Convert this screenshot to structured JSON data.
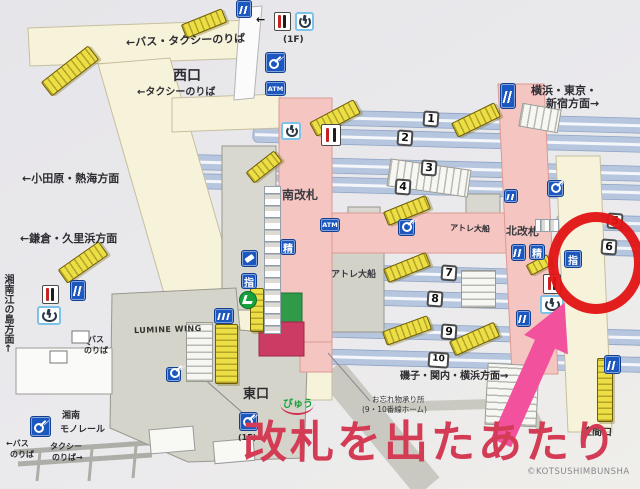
{
  "map": {
    "annotation": {
      "headline": "改札を出たあたり",
      "copyright": "©KOTSUSHIMBUNSHA"
    },
    "exits": {
      "west": "西口",
      "east": "東口",
      "kasama": "笠間口"
    },
    "gates": {
      "south": "南改札",
      "north": "北改札"
    },
    "directions": {
      "bus_taxi_top": "←バス・タクシーのりば",
      "taxi_west": "←タクシーのりば",
      "yokohama_line1": "横浜・東京・",
      "yokohama_line2": "新宿方面→",
      "odawara": "←小田原・熱海方面",
      "kamakura": "←鎌倉・久里浜方面",
      "enoshima": "湘南江の島方面←",
      "isogo": "磯子・関内・横浜方面→"
    },
    "facilities": {
      "atre_corridor": "アトレ大船",
      "atre_building": "アトレ大船",
      "lumine": "LUMINE WING",
      "view_plaza": "びゅう",
      "lost_found_line1": "お忘れ物承り所",
      "lost_found_line2": "(9・10番線ホーム)",
      "monorail_line1": "湘南",
      "monorail_line2": "モノレール",
      "bus_stop_line1": "バス",
      "bus_stop_line2": "のりば",
      "bus_bl_line1": "←バス",
      "bus_bl_line2": "のりば",
      "taxi_bl_line1": "タクシー",
      "taxi_bl_line2": "のりば→",
      "floor_top": "(1F)",
      "floor_locker": "(1F)"
    },
    "icon_labels": {
      "atm": "ATM",
      "fare_adjustment": "精",
      "reserved_seat": "指",
      "arrow_left": "←"
    },
    "platforms": [
      "1",
      "2",
      "3",
      "4",
      "5",
      "6",
      "7",
      "8",
      "9",
      "10"
    ],
    "colors": {
      "annotation_red": "#e21313",
      "headline_red": "#d43b55",
      "arrow_pink": "#f2519e",
      "corridor_pink": "#f4c5c1",
      "walkway_cream": "#f7f2da",
      "track_blue": "#b6c6df",
      "icon_blue": "#1b57be",
      "escalator_yellow": "#ecdf46",
      "midori_green": "#2f9a47",
      "view_crimson": "#cb3b63"
    }
  }
}
